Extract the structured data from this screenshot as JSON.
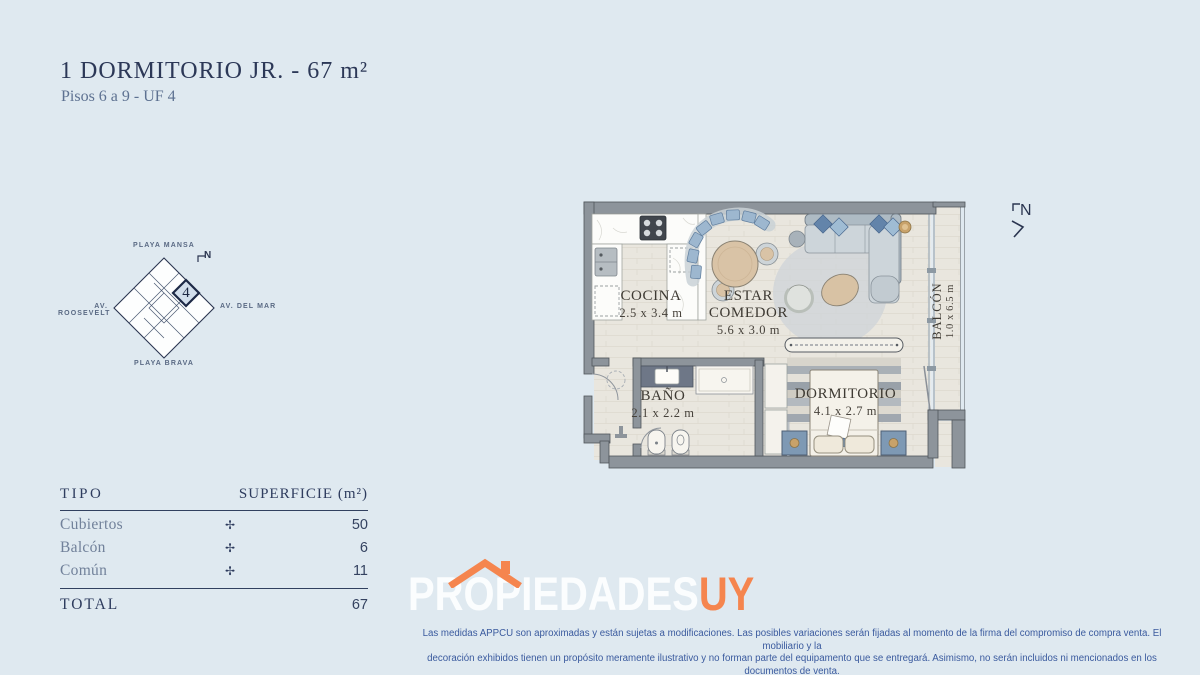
{
  "colors": {
    "background": "#dfe9f0",
    "navy": "#2c3857",
    "slate": "#5d7191",
    "orange": "#f5854e",
    "logo_white": "#fbfdfe",
    "disclaimer_blue": "#3a5a9e",
    "wall_gray": "#8d949b",
    "floor_beige": "#e9e6de"
  },
  "header": {
    "title": "1 DORMITORIO JR.  - 67 m²",
    "subtitle": "Pisos 6 a 9 - UF 4"
  },
  "keymap": {
    "label_top": "PLAYA MANSA",
    "label_left": "AV. ROOSEVELT",
    "label_right": "AV. DEL MAR",
    "label_bottom": "PLAYA BRAVA",
    "unit_number": "4",
    "north_label": "N"
  },
  "floorplan": {
    "north_label": "N",
    "rooms": [
      {
        "name": "COCINA",
        "dims": "2.5 x 3.4 m"
      },
      {
        "name": "ESTAR COMEDOR",
        "dims": "5.6 x 3.0 m"
      },
      {
        "name": "BAÑO",
        "dims": "2.1 x 2.2 m"
      },
      {
        "name": "DORMITORIO",
        "dims": "4.1 x 2.7 m"
      },
      {
        "name": "BALCÓN",
        "dims": "1.0 x 6.5 m"
      }
    ]
  },
  "table": {
    "col_tipo": "TIPO",
    "col_superficie": "SUPERFICIE (m²)",
    "rows": [
      {
        "label": "Cubiertos",
        "symbol": "✢",
        "value": "50"
      },
      {
        "label": "Balcón",
        "symbol": "✢",
        "value": "6"
      },
      {
        "label": "Común",
        "symbol": "✢",
        "value": "11"
      }
    ],
    "total_label": "TOTAL",
    "total_value": "67"
  },
  "logo": {
    "name_main": "PROPIEDADES",
    "name_suffix": "UY"
  },
  "disclaimer": {
    "line1": "Las medidas APPCU son aproximadas y están sujetas a modificaciones. Las posibles variaciones serán fijadas al momento de la firma del compromiso de compra venta.  El mobiliario y la",
    "line2": "decoración exhibidos tienen un propósito meramente ilustrativo y no forman parte del equipamento que se entregará. Asimismo, no serán incluidos ni mencionados en los documentos de venta."
  }
}
